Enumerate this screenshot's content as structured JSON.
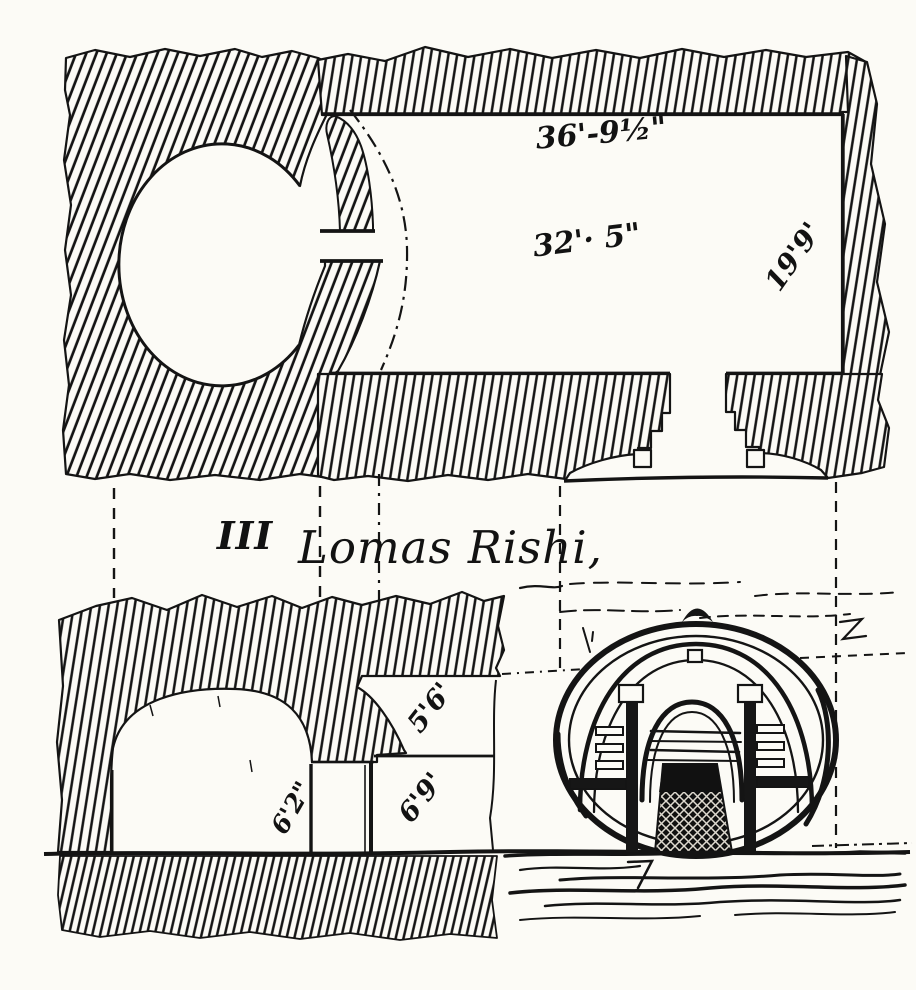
{
  "page": {
    "paper_color": "#fcfbf6",
    "ink_color": "#121212",
    "description": "Engraved archaeological drawing: plan, section and entrance elevation of the Lomas Rishi cave"
  },
  "caption": {
    "numeral": "III",
    "title": "Lomas Rishi,"
  },
  "plan": {
    "label_top_length": "36'-9½\"",
    "label_mid_length": "32'· 5\"",
    "label_side_width": "19'9'"
  },
  "section": {
    "label_upper_opening": "5'6'",
    "label_lower_opening": "6'9'",
    "label_step_height": "6'2\""
  }
}
